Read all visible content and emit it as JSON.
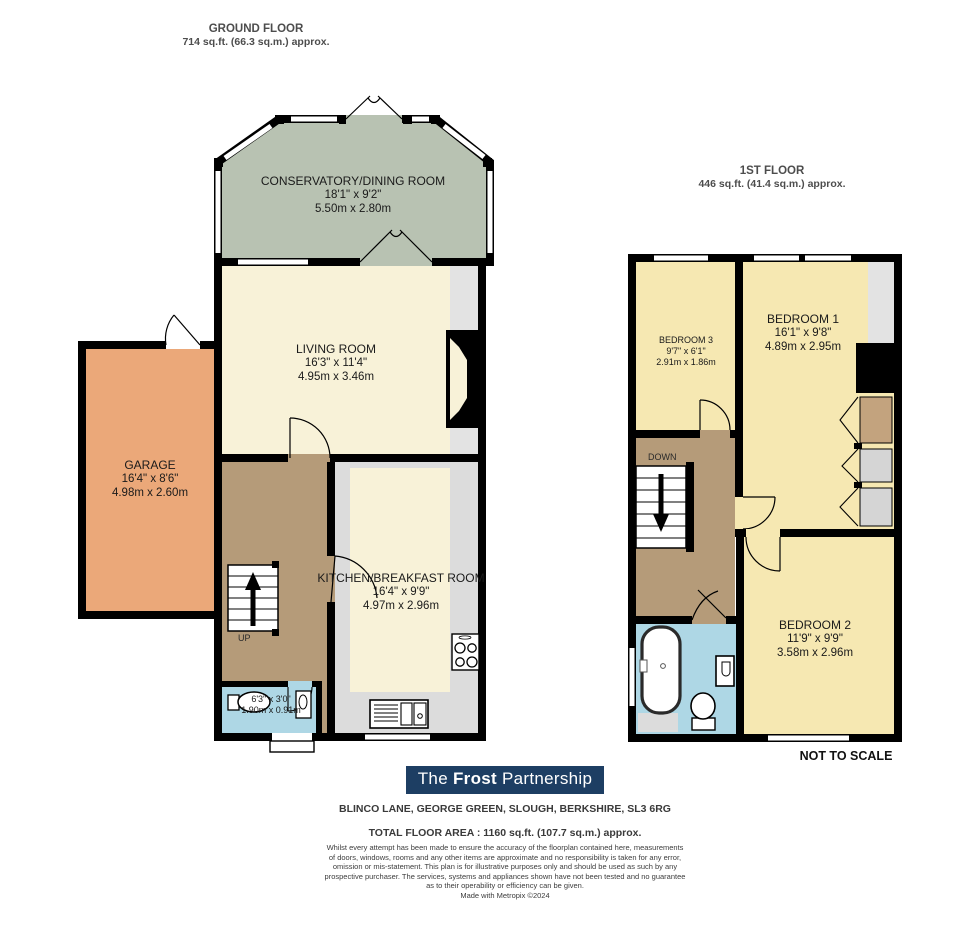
{
  "ground_floor": {
    "title": "GROUND FLOOR",
    "area": "714 sq.ft. (66.3 sq.m.) approx.",
    "stairs_label": "UP",
    "rooms": [
      {
        "name": "CONSERVATORY/DINING ROOM",
        "size_imperial": "18'1\" x 9'2\"",
        "size_metric": "5.50m x 2.80m"
      },
      {
        "name": "LIVING ROOM",
        "size_imperial": "16'3\" x 11'4\"",
        "size_metric": "4.95m x 3.46m"
      },
      {
        "name": "GARAGE",
        "size_imperial": "16'4\" x 8'6\"",
        "size_metric": "4.98m x 2.60m"
      },
      {
        "name": "KITCHEN/BREAKFAST ROOM",
        "size_imperial": "16'4\" x 9'9\"",
        "size_metric": "4.97m x 2.96m"
      },
      {
        "size_imperial": "6'3\" x 3'0\"",
        "size_metric": "1.90m x 0.91m"
      }
    ]
  },
  "first_floor": {
    "title": "1ST FLOOR",
    "area": "446 sq.ft. (41.4 sq.m.) approx.",
    "stairs_label": "DOWN",
    "rooms": [
      {
        "name": "BEDROOM 1",
        "size_imperial": "16'1\" x 9'8\"",
        "size_metric": "4.89m x 2.95m"
      },
      {
        "name": "BEDROOM 2",
        "size_imperial": "11'9\" x 9'9\"",
        "size_metric": "3.58m x 2.96m"
      },
      {
        "name": "BEDROOM 3",
        "size_imperial": "9'7\" x 6'1\"",
        "size_metric": "2.91m x 1.86m"
      }
    ]
  },
  "footer": {
    "not_to_scale": "NOT TO SCALE",
    "logo": {
      "part1": "The",
      "part2": "Frost",
      "part3": "Partnership"
    },
    "address": "BLINCO LANE, GEORGE GREEN, SLOUGH, BERKSHIRE, SL3 6RG",
    "total_area": "TOTAL FLOOR AREA : 1160 sq.ft. (107.7 sq.m.) approx.",
    "disclaimer_lines": [
      "Whilst every attempt has been made to ensure the accuracy of the floorplan contained here, measurements",
      "of doors, windows, rooms and any other items are approximate and no responsibility is taken for any error,",
      "omission or mis-statement. This plan is for illustrative purposes only and should be used as such by any",
      "prospective purchaser. The services, systems and appliances shown have not been tested and no guarantee",
      "as to their operability or efficiency can be given."
    ],
    "credit": "Made with Metropix ©2024"
  },
  "colors": {
    "wall": "#000000",
    "conservatory_fill": "#b8c2b2",
    "living_fill": "#f8f2d8",
    "bedroom_fill": "#f6e8b2",
    "garage_fill": "#eba879",
    "hall_fill": "#b59b79",
    "kitchen_floor": "#dcdcdc",
    "bathroom_fill": "#aed7e5",
    "gray_detail": "#e3e3e3",
    "wardrobe_tan": "#c3a37e",
    "logo_bg": "#1d3e63",
    "logo_text": "#ffffff"
  }
}
